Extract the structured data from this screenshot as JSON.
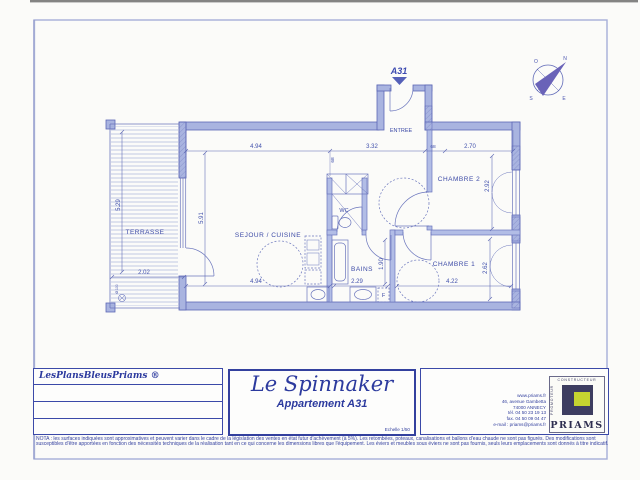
{
  "plan": {
    "unit_label": "A31",
    "rooms": {
      "entree": "ENTREE",
      "sejour": "SEJOUR / CUISINE",
      "terrasse": "TERRASSE",
      "wc": "WC",
      "bains": "BAINS",
      "chambre1": "CHAMBRE 1",
      "chambre2": "CHAMBRE 2"
    },
    "dimensions": {
      "sejour_width_top": "4.94",
      "hall_width": "3.32",
      "chambre2_width": "2.70",
      "door_width_a": "68",
      "door_width_b": "68",
      "sejour_height": "5.91",
      "sejour_width_bottom": "4.94",
      "terrasse_height": "5.29",
      "terrasse_width": "2.02",
      "bains_width": "2.29",
      "bains_height": "1.90",
      "chambre1_width": "4.22",
      "chambre1_height": "2.62",
      "chambre2_height": "2.92"
    },
    "fixtures": {
      "bath_box_label": "F",
      "drain_label": "Ø 100"
    },
    "compass": {
      "n": "N",
      "s": "S",
      "e": "E",
      "o": "O"
    }
  },
  "title_block": {
    "left_box": {
      "brand": "LesPlansBleusPriams ®"
    },
    "center_box": {
      "residence": "Le Spinnaker",
      "apartment": "Appartement A31",
      "scale": "Echelle 1/50"
    },
    "right_box": {
      "contact": [
        "www.priams.fr",
        "46, avenue Gambetta",
        "74000 ANNECY",
        "tél. 04 50 23 19 13",
        "fax. 04 50 09 04 47",
        "e-mail : priams@priams.fr"
      ],
      "logo_top": "CONSTRUCTEUR",
      "logo_side": "PROMOTEUR",
      "logo_text": "PRIAMS"
    }
  },
  "nota": {
    "line1": "NOTA : les surfaces indiquées sont approximatives et peuvent varier dans le cadre de la législation des ventes en état futur d'achèvement (à 5%). Les retombées, poteaux, canalisations et ballons d'eau chaude ne sont pas figurés. Des modifications sont",
    "line2": "susceptibles d'être apportées en fonction des nécessités techniques de la réalisation tant en ce qui concerne les dimensions libres que l'équipement. Les éviers et meubles sous éviers ne sont pas fournis, seuls leurs emplacements sont donnés à titre indicatif."
  },
  "colors": {
    "wall_fill": "#a9b4e0",
    "wall_stroke": "#5c67b6",
    "ink": "#3a48a5",
    "logo_navy": "#3d3d60",
    "logo_green": "#c5d430"
  }
}
